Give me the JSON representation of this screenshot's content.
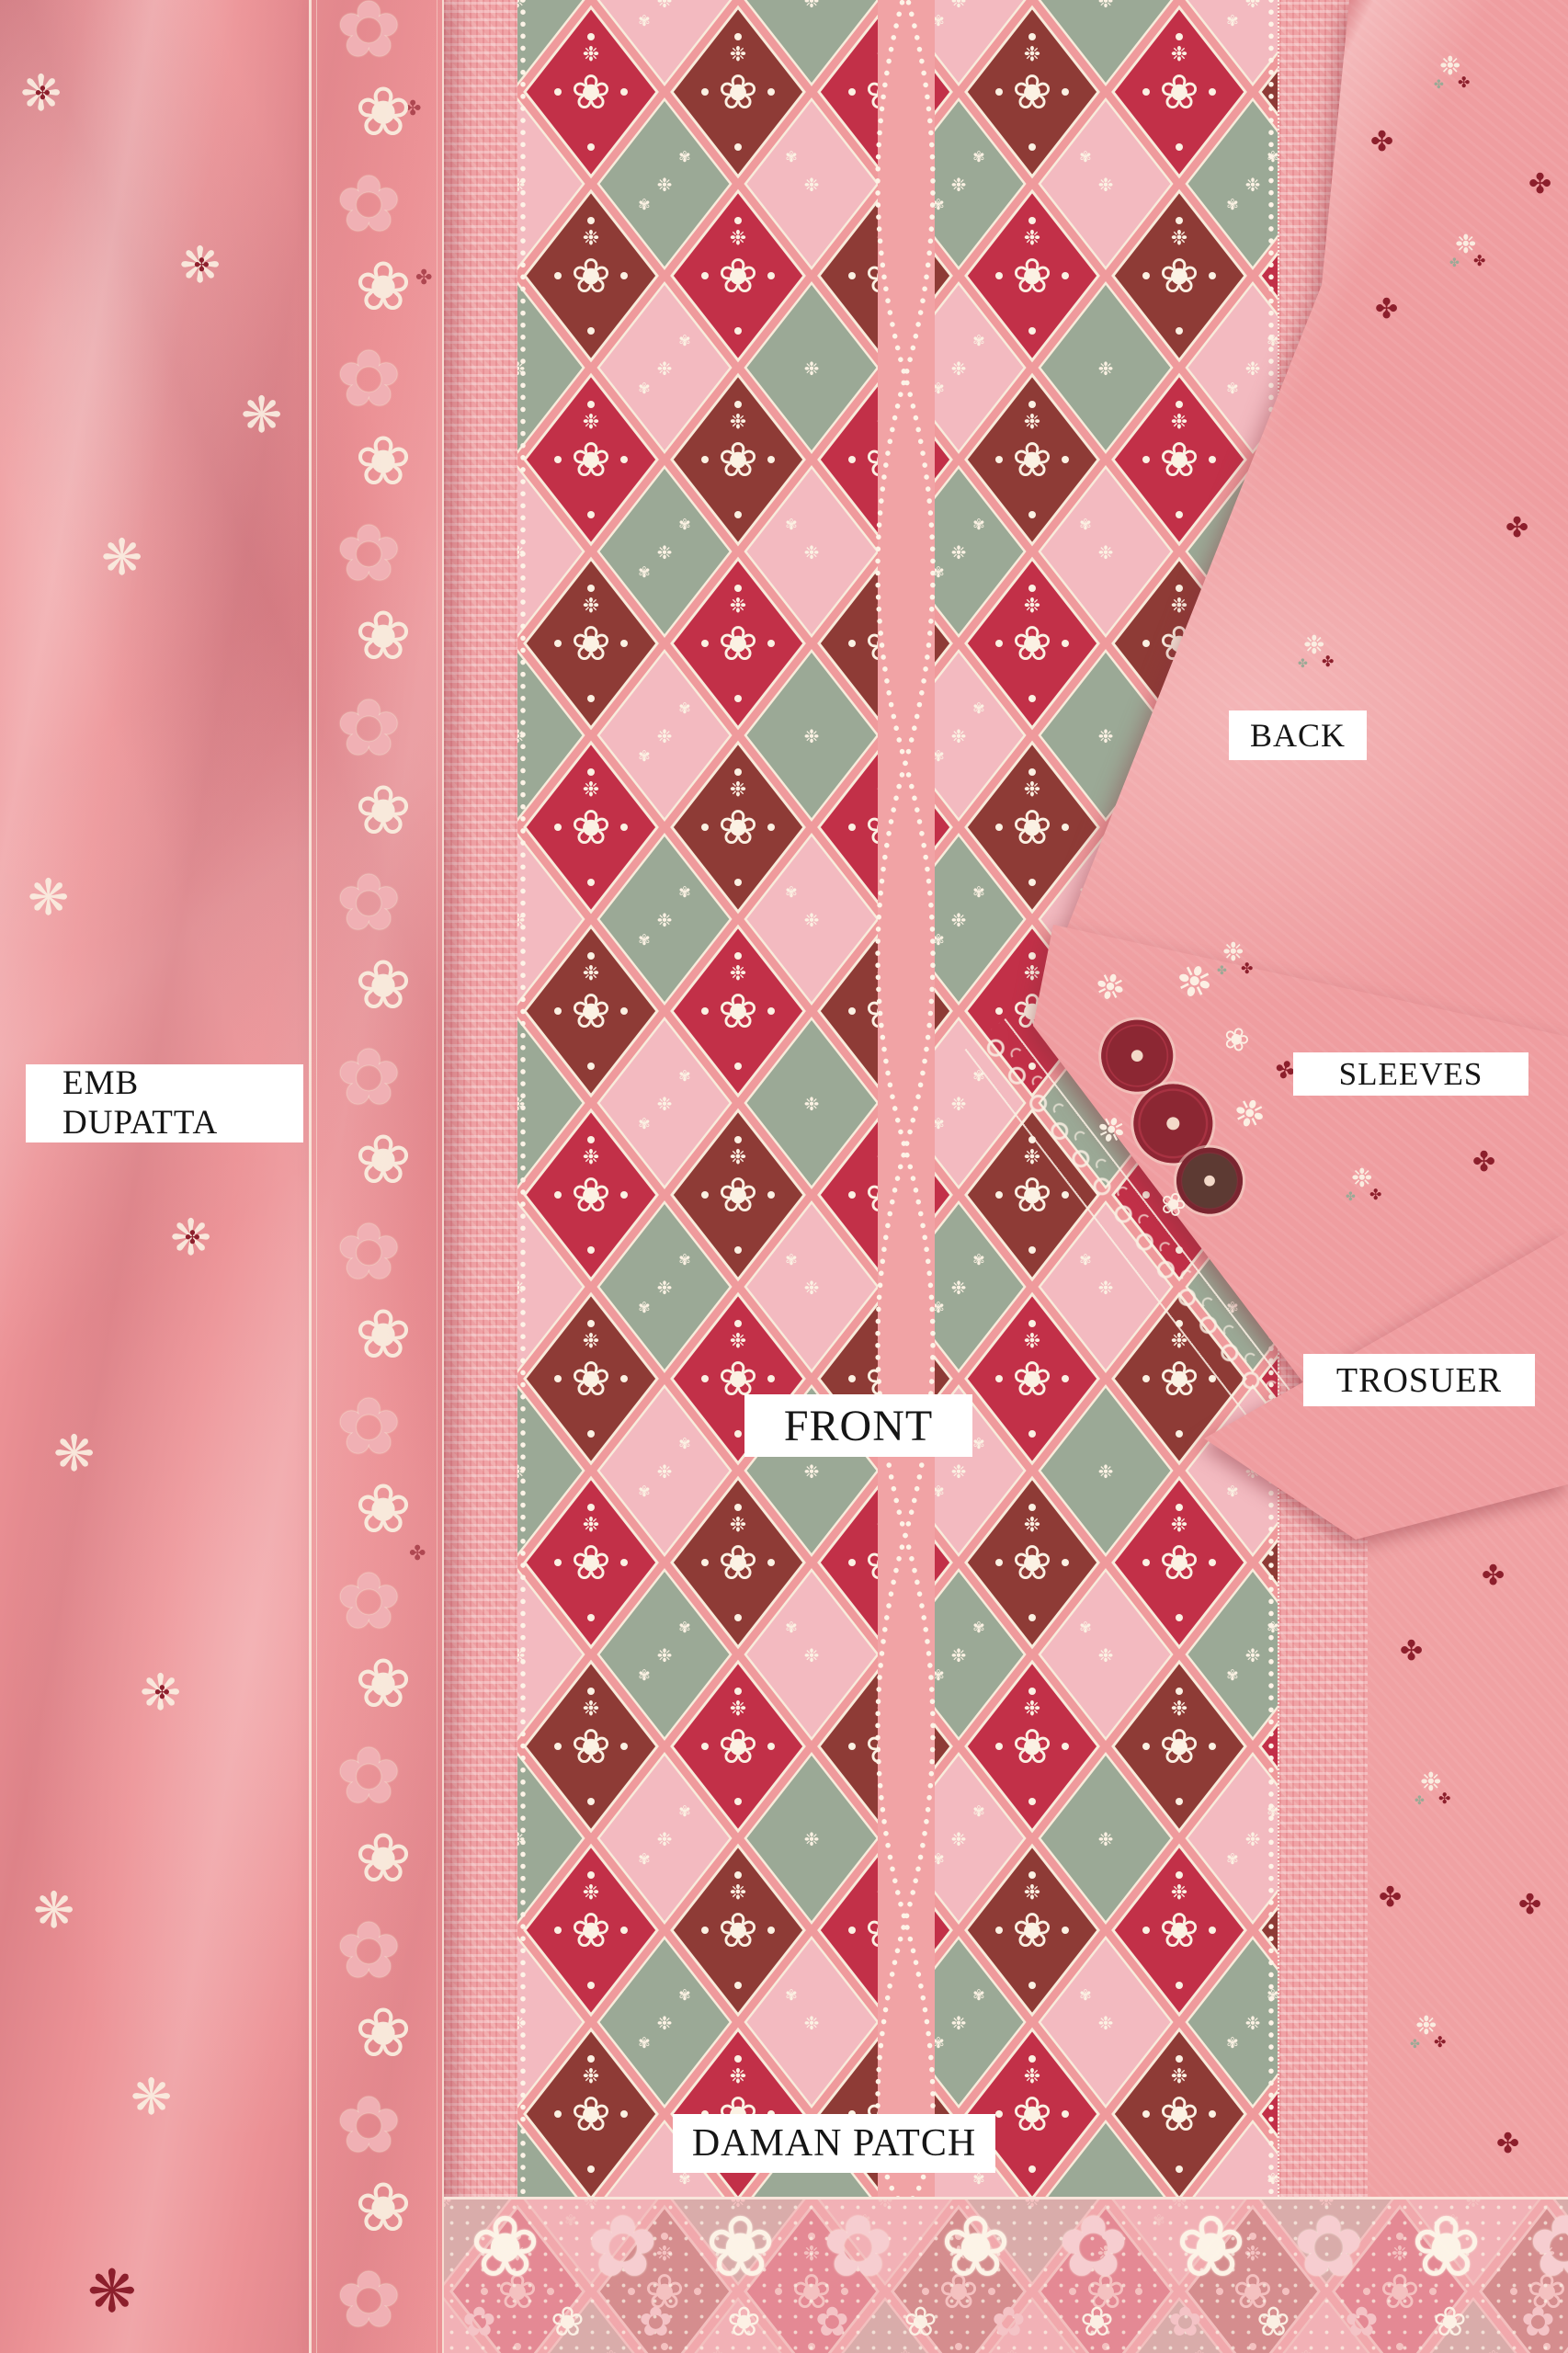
{
  "photo": {
    "description": "Flat-lay product photo of a pink embroidered unstitched suit: draped dupatta, diamond-lattice embroidered front panel, folded back, sleeves and trouser pieces, heavy daman border",
    "labels": {
      "emb_dupatta_line1": "EMB",
      "emb_dupatta_line2": "DUPATTA",
      "front": "FRONT",
      "back": "BACK",
      "sleeves": "SLEEVES",
      "trouser": "TROSUER",
      "daman_patch": "DAMAN PATCH"
    },
    "palette": {
      "base_pink": "#ec9598",
      "panel_pink": "#ef9a9c",
      "crimson": "#c23048",
      "maroon": "#8e3b36",
      "sage_green": "#9ba996",
      "blush": "#f3bac0",
      "cream": "#f6e9d9",
      "deep_red": "#8c1f2c",
      "label_bg": "#ffffff",
      "label_text": "#151515"
    },
    "icons": {
      "flower_outline": "❀",
      "flower_filled": "✿",
      "star_flower": "❋",
      "sparkle": "❉",
      "cross_floret": "✤"
    }
  }
}
